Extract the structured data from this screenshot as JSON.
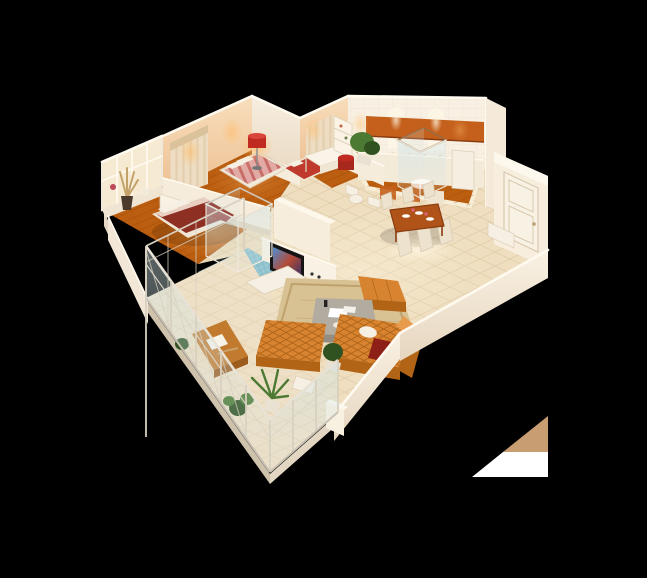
{
  "scene": {
    "title": "3D isometric apartment floor-plan render on black background",
    "type": "architectural-3d-render",
    "objects": [
      "master-bedroom-with-maroon-bed",
      "bedroom-with-pink-striped-bed",
      "small-bedroom-red-bed",
      "study-with-white-desk-and-red-stool",
      "white-bookshelf",
      "red-drum-floor-lamp",
      "window-wall-with-dried-plants",
      "curtained-back-walls",
      "kitchen-with-orange-cabinets",
      "tiled-kitchen-wall-with-niches",
      "glass-shower-cube-bathroom",
      "blue-mosaic-bathroom",
      "toilet",
      "tv-partition-wall-with-flat-tv",
      "dining-table-with-white-chairs",
      "living-room-orange-tufted-sofas",
      "gray-coffee-table",
      "beige-rug",
      "orange-ottoman",
      "entry-door-white-paneled",
      "low-perimeter-walls",
      "balcony-with-glass-railing",
      "balcony-wood-table",
      "potted-plants",
      "corner-graphic-triangle"
    ]
  },
  "colors": {
    "background": "#000000",
    "slab": "#e3d7c3",
    "slabDark": "#cfc2ad",
    "wallCream": "#f7eee0",
    "wallCreamDark": "#eadbc4",
    "wallPeachLight": "#f8debc",
    "wallPeachDark": "#edbf92",
    "wallTopStroke": "#fffaf0",
    "woodFloor": "#bc5e10",
    "woodLine": "#8f4409",
    "tileFloor": "#efdfc0",
    "tileLine": "#d8c29c",
    "tileBright": "#f8edd6",
    "balconyFloor": "#eee0c6",
    "mosaicBlue": "#8cc0cc",
    "mosaicLine": "#eaf4f6",
    "glass": "#cfe4e6",
    "railPost": "#d8d0c0",
    "cabinetOrange": "#c4601c",
    "counter": "#f4ead8",
    "doorWhite": "#f8f2e4",
    "doorTrim": "#d9c9ae",
    "sofaOrange": "#d8832f",
    "sofaDark": "#b26416",
    "sofaLight": "#e99b4d",
    "tuftLine": "#a55d14",
    "rug": "#d8c193",
    "rugBorder": "#bfa26b",
    "tableGray": "#b2aba0",
    "tableGraySide": "#948d81",
    "woodFurn": "#b05318",
    "woodFurnDark": "#8a3c10",
    "chairWhite": "#ece2cd",
    "bedMaroon": "#8e2f24",
    "sheetFold": "#e9d0c3",
    "bedPink": "#e2aaa4",
    "bedStripe": "#c4625e",
    "bedRed": "#bf3a2d",
    "pillow": "#f6efe3",
    "curtain": "#eeddc2",
    "curtainShadow": "#d9c29c",
    "redAccent": "#c02a20",
    "redDark": "#8e1f16",
    "tvBlack": "#161412",
    "plantGreen": "#4c7a33",
    "plantDark": "#2f5220",
    "pot": "#e9e1d1",
    "driedPlant": "#c2a268",
    "glowWarm": "#ffbe6e",
    "glowWhite": "#fff6e0",
    "artifactTan": "#c89d72",
    "artifactWhite": "#ffffff"
  },
  "artifact": {
    "description": "clipped tan/white triangle graphic at lower right",
    "tan_points": "548,416 548,452 503,452",
    "white_points": "503,452 548,452 548,477 472,477"
  }
}
